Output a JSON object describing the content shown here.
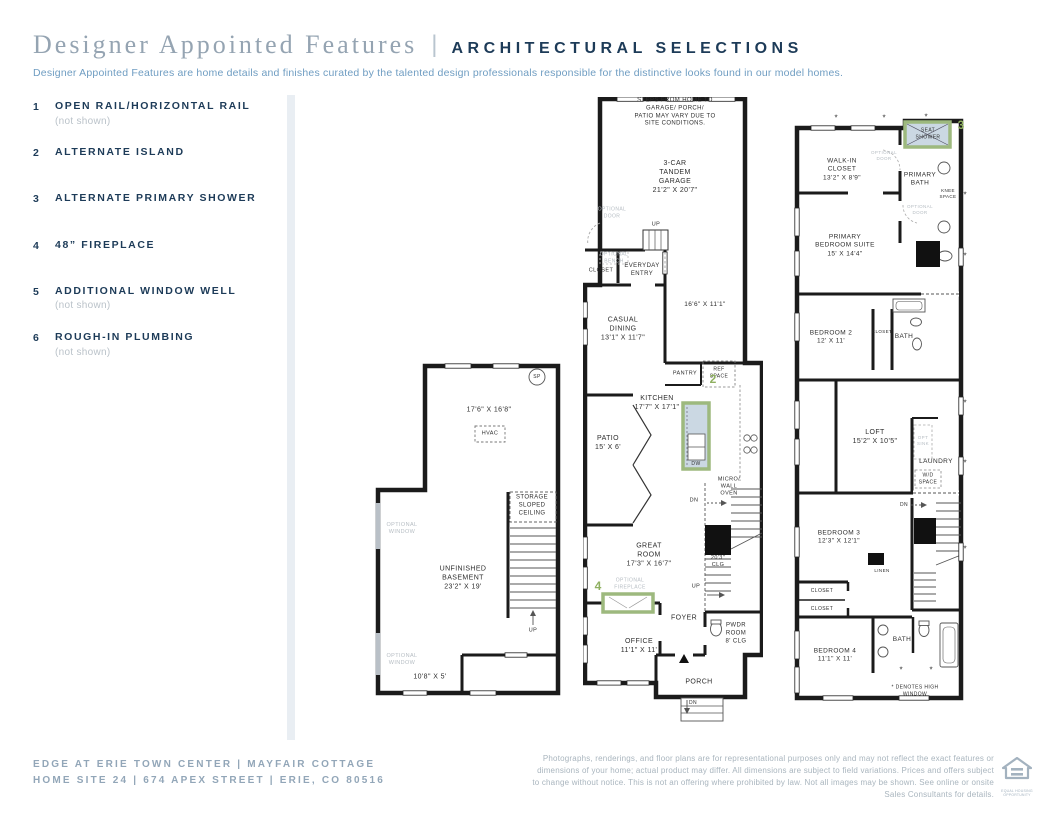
{
  "header": {
    "title_serif": "Designer Appointed Features",
    "separator": "|",
    "title_caps": "ARCHITECTURAL SELECTIONS",
    "subtitle": "Designer Appointed Features are home details and finishes curated by the talented design professionals responsible for the distinctive looks found in our model homes."
  },
  "features": [
    {
      "num": "1",
      "label": "OPEN RAIL/HORIZONTAL RAIL",
      "note": "(not shown)"
    },
    {
      "num": "2",
      "label": "ALTERNATE ISLAND",
      "note": ""
    },
    {
      "num": "3",
      "label": "ALTERNATE PRIMARY SHOWER",
      "note": ""
    },
    {
      "num": "4",
      "label": "48” FIREPLACE",
      "note": ""
    },
    {
      "num": "5",
      "label": "ADDITIONAL WINDOW WELL",
      "note": "(not shown)"
    },
    {
      "num": "6",
      "label": "ROUGH-IN PLUMBING",
      "note": "(not shown)"
    }
  ],
  "plans": {
    "basement": {
      "sp": "SP",
      "dim_upper": "17'6\" X 16'8\"",
      "hvac": "HVAC",
      "optional_window1": "OPTIONAL\nWINDOW",
      "storage": "STORAGE\nSLOPED\nCEILING",
      "room": "UNFINISHED\nBASEMENT\n23'2\" X 19'",
      "optional_window2": "OPTIONAL\nWINDOW",
      "dim_lower": "10'8\" X 5'",
      "up": "UP"
    },
    "main": {
      "site_note": "STEPS FROM HOME TO GARAGE/ PORCH/\nPATIO MAY VARY DUE TO SITE CONDITIONS.",
      "garage": "3-CAR\nTANDEM\nGARAGE\n21'2\" X 20'7\"",
      "optional_door": "OPTIONAL\nDOOR",
      "up": "UP",
      "optional_bench": "OPTIONAL\nBENCH",
      "closet": "CLOSET",
      "everyday_entry": "EVERYDAY\nENTRY",
      "garage_dim2": "16'6\" X 11'1\"",
      "casual_dining": "CASUAL\nDINING\n13'1\" X 11'7\"",
      "pantry": "PANTRY",
      "ref_space": "REF\nSPACE",
      "kitchen": "KITCHEN\n17'7\" X 17'1\"",
      "patio": "PATIO\n15' X 6'",
      "num2": "2",
      "dw": "DW",
      "micro": "MICRO/\nWALL\nOVEN",
      "great_room": "GREAT\nROOM\n17'3\" X 16'7\"",
      "dn": "DN",
      "clg": "20'3\"\nCLG",
      "up2": "UP",
      "num4": "4",
      "optional_fireplace": "OPTIONAL\nFIREPLACE",
      "foyer": "FOYER",
      "pwdr": "PWDR\nROOM\n8' CLG",
      "office": "OFFICE\n11'1\" X 11'",
      "porch": "PORCH",
      "dn2": "DN"
    },
    "upper": {
      "num3": "3",
      "seat_shower": "SEAT\nSHOWER",
      "walk_in": "WALK-IN\nCLOSET\n13'2\" X 8'9\"",
      "optional_door1": "OPTIONAL\nDOOR",
      "primary_bath": "PRIMARY\nBATH",
      "knee_space": "KNEE\nSPACE",
      "optional_door2": "OPTIONAL\nDOOR",
      "primary_bedroom": "PRIMARY\nBEDROOM SUITE\n15' X 14'4\"",
      "bedroom2": "BEDROOM 2\n12' X 11'",
      "closet": "CLOSET",
      "bath": "BATH",
      "loft": "LOFT\n15'2\" X 10'5\"",
      "opt_sink": "OPT\nSINK",
      "laundry": "LAUNDRY",
      "wd_space": "W/D\nSPACE",
      "dn": "DN",
      "bedroom3": "BEDROOM 3\n12'3\" X 12'1\"",
      "linen": "LINEN",
      "closet2": "CLOSET",
      "closet3": "CLOSET",
      "bedroom4": "BEDROOM 4\n11'1\" X 11'",
      "bath2": "BATH",
      "high_window": "* DENOTES HIGH WINDOW",
      "asterisk": "*"
    }
  },
  "footer": {
    "community": "EDGE AT ERIE TOWN CENTER | MAYFAIR COTTAGE",
    "address": "HOME SITE 24 | 674 APEX STREET | ERIE, CO 80516",
    "disclaimer": "Photographs, renderings, and floor plans are for representational purposes only and may not reflect the exact features or dimensions of your home; actual product may differ. All dimensions are subject to field variations. Prices and offers subject to change without notice. This is not an offering where prohibited by law. Not all images may be shown. See online or onsite Sales Consultants for details.",
    "eho_label": "EQUAL HOUSING OPPORTUNITY"
  },
  "colors": {
    "navy": "#1d3b58",
    "title_gray": "#95a4b2",
    "subtitle_blue": "#6f9dc2",
    "highlight_green": "#9db97e",
    "highlight_fill": "#cbd8e3",
    "wall_black": "#1b1b1b",
    "muted_gray": "#b6bdc3"
  }
}
